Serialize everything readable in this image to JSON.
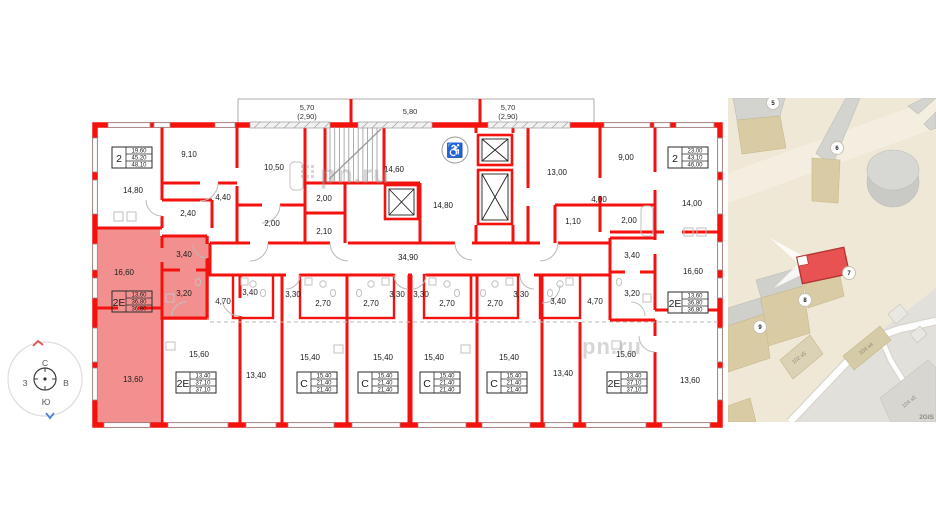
{
  "plan": {
    "watermark": "pn.ru",
    "balcony": [
      "5,70",
      "(2,90)",
      "5,80",
      "5,70",
      "(2,90)"
    ],
    "rooms": [
      "14,80",
      "9,10",
      "10,50",
      "4,40",
      "2,40",
      "2,00",
      "2,00",
      "2,10",
      "14,60",
      "14,80",
      "34,90",
      "13,00",
      "9,00",
      "4,00",
      "1,10",
      "2,00",
      "14,00",
      "16,60",
      "3,40",
      "3,20",
      "13,60",
      "15,60",
      "4,70",
      "3,40",
      "13,40",
      "3,30",
      "2,70",
      "15,40",
      "2,70",
      "3,30",
      "15,40",
      "3,30",
      "2,70",
      "15,40",
      "2,70",
      "3,30",
      "15,40",
      "3,40",
      "13,40",
      "4,70",
      "15,60",
      "3,40",
      "3,20",
      "16,60",
      "13,60"
    ],
    "stat_boxes": [
      {
        "type": "2",
        "v1": "19,60",
        "v2": "45,20",
        "v3": "48,10"
      },
      {
        "type": "2",
        "v1": "23,00",
        "v2": "43,10",
        "v3": "46,00"
      },
      {
        "type": "2Е",
        "v1": "13,60",
        "v2": "36,80",
        "v3": "36,80"
      },
      {
        "type": "2Е",
        "v1": "13,60",
        "v2": "36,80",
        "v3": "36,80"
      },
      {
        "type": "2Е",
        "v1": "13,40",
        "v2": "37,10",
        "v3": "37,10"
      },
      {
        "type": "2Е",
        "v1": "13,40",
        "v2": "37,10",
        "v3": "37,10"
      },
      {
        "type": "С",
        "v1": "15,40",
        "v2": "21,40",
        "v3": "21,40"
      },
      {
        "type": "С",
        "v1": "15,40",
        "v2": "21,40",
        "v3": "21,40"
      },
      {
        "type": "С",
        "v1": "15,40",
        "v2": "21,40",
        "v3": "21,40"
      },
      {
        "type": "С",
        "v1": "15,40",
        "v2": "21,40",
        "v3": "21,40"
      }
    ]
  },
  "compass": {
    "north": "С",
    "east": "В",
    "south": "Ю",
    "west": "З"
  },
  "map": {
    "badges": [
      "5",
      "6",
      "7",
      "8",
      "9"
    ],
    "building_labels": [
      "104 к4",
      "102 к5",
      "104 к5"
    ],
    "provider": "2GIS"
  },
  "colors": {
    "wall": "#f3120e",
    "highlight": "#f29090",
    "map_bg": "#efe8d7",
    "selected_building": "#e85252"
  }
}
